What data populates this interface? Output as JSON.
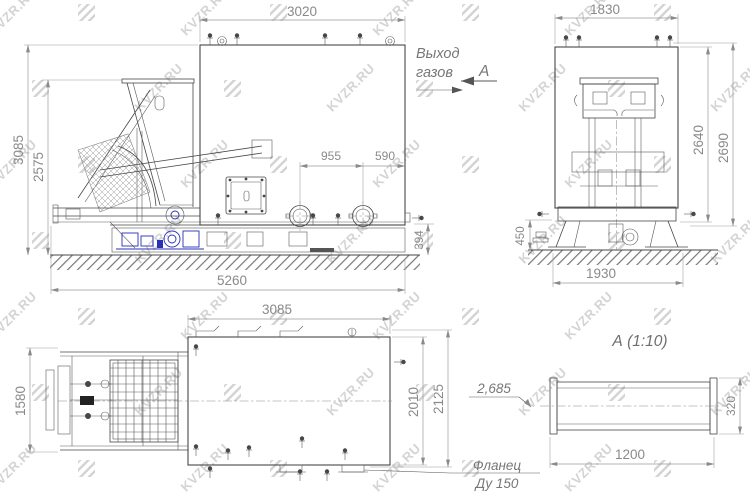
{
  "watermark": {
    "text": "KVZR.RU"
  },
  "side_view": {
    "dim_body_length": "3020",
    "dim_total_height": "3085",
    "dim_hopper_height": "2575",
    "dim_flange_spacing": "955",
    "dim_flange_offset": "590",
    "dim_valve_height": "394",
    "dim_total_length": "5260",
    "label_gas_outlet_1": "Выход",
    "label_gas_outlet_2": "газов",
    "label_view_arrow": "А"
  },
  "front_view": {
    "dim_width": "1830",
    "dim_height_inner": "2640",
    "dim_height_outer": "2690",
    "dim_valve_height": "450",
    "dim_base_width": "1930"
  },
  "plan_view": {
    "dim_length": "3085",
    "dim_cart_width": "1580",
    "dim_width_inner": "2010",
    "dim_width_outer": "2125",
    "label_note": "2,685",
    "label_flange_1": "Фланец",
    "label_flange_2": "Ду 150"
  },
  "detail_view": {
    "title": "А (1:10)",
    "dim_length": "1200",
    "dim_height": "320"
  },
  "colors": {
    "line": "#474747",
    "dim": "#8a8a8a",
    "accent_blue": "#2a2fb8",
    "watermark": "#d4d4d4"
  }
}
